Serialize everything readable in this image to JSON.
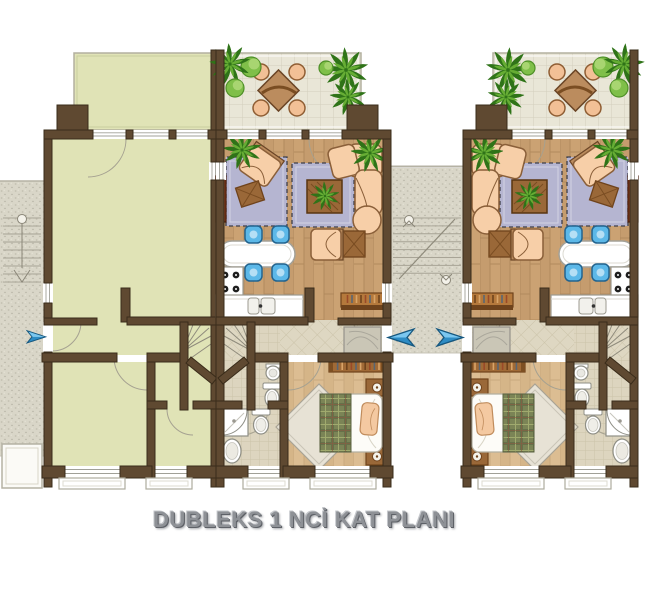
{
  "title": {
    "text": "DUBLEKS 1 NCİ  KAT PLANI"
  },
  "plan": {
    "units": [
      {
        "id": "neighbor-unit-shell",
        "description": "adjoining duplex unit drawn as unfurnished olive shell"
      },
      {
        "id": "left-duplex-unit",
        "description": "furnished duplex unit (mirrored twin)"
      },
      {
        "id": "right-duplex-unit",
        "description": "furnished duplex unit"
      }
    ],
    "rooms": [
      "terrace",
      "living-room",
      "kitchen",
      "entry-hall",
      "bedroom",
      "wc",
      "bathroom",
      "winder-stairs"
    ],
    "site_features": [
      "outdoor-side-stairs",
      "shared-entry-stairwell",
      "entrance-arrows",
      "window-planter"
    ],
    "entrance_arrows": [
      {
        "target": "neighbor-unit-shell",
        "direction": "right"
      },
      {
        "target": "left-duplex-unit",
        "direction": "left"
      },
      {
        "target": "right-duplex-unit",
        "direction": "right"
      }
    ],
    "colors": {
      "wall": "#5f4931",
      "wall_stroke": "#3a2c1a",
      "olive_floor": "#e0e3b6",
      "olive_line": "#bcbf92",
      "terrace_tile": "#e9e6d7",
      "tile_line": "#d2cfbc",
      "hall_tile": "#ded7c2",
      "hall_line": "#cbc3a9",
      "bath_tile": "#ddd5bf",
      "bath_line": "#cbc3a8",
      "wood_living": "#cba273",
      "wood_living_line": "#b18a5d",
      "wood_bedroom": "#dcbd92",
      "wood_bedroom_line": "#c9a97e",
      "stone": "#d9d6c8",
      "rug": "#b5b5d1",
      "rug_border": "#3f3f4a",
      "sofa": "#f7cfa8",
      "sofa_stroke": "#8a5f39",
      "chair_blue": "#5cb8e8",
      "chair_blue_stroke": "#23648f",
      "wood_furniture": "#9a6838",
      "wood_furniture_dark": "#6f431c",
      "tv_unit": "#8a3c1c",
      "plant_dark": "#2f7318",
      "plant_light": "#66ad34",
      "bush": "#7fbf49",
      "bush_stroke": "#4e8f27",
      "bed_blanket": "#7b8456",
      "fixture_stroke": "#8f8f86",
      "arrow_light": "#7ac7f0",
      "arrow_dark": "#2e8cc4",
      "arrow_stroke": "#15577f",
      "title_color": "#8e9196",
      "title_shadow": "#5e6167"
    }
  }
}
